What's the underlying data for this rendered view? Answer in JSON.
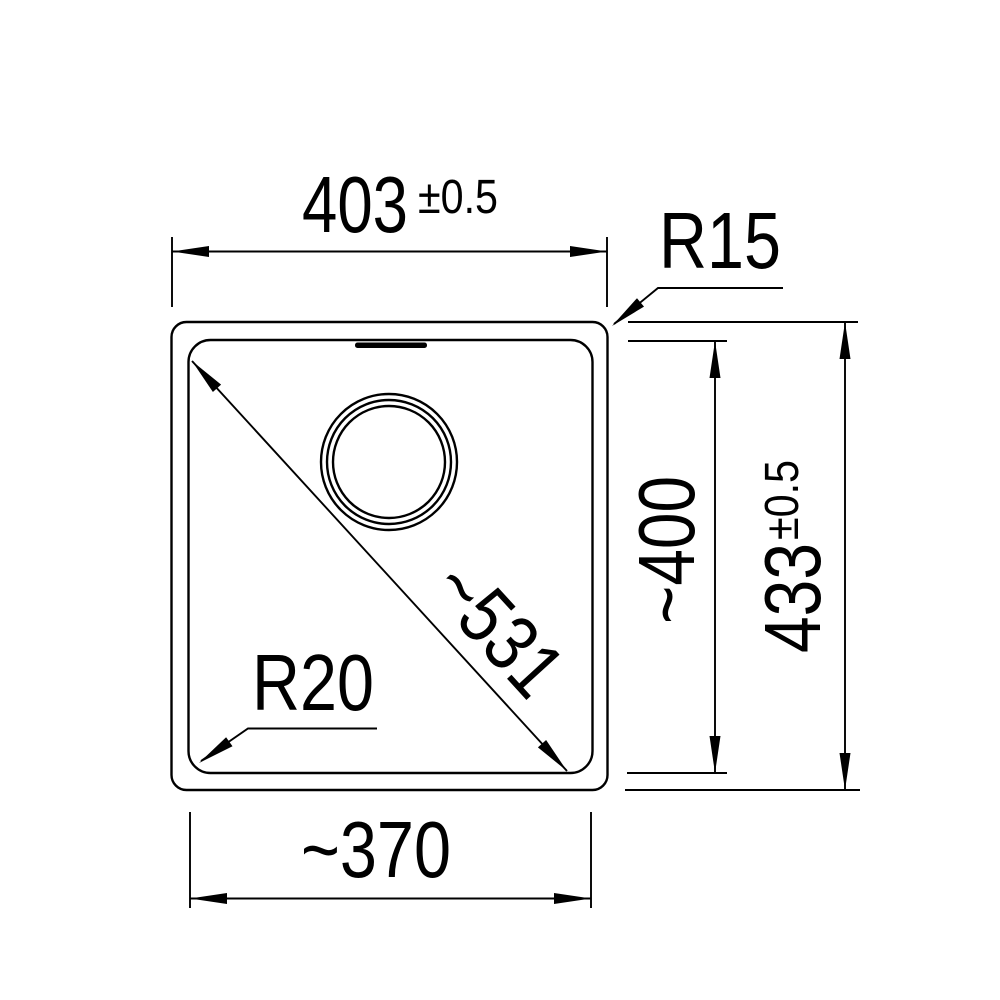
{
  "drawing_type": "technical dimension drawing",
  "colors": {
    "line": "#000000",
    "background": "#ffffff"
  },
  "labels": {
    "top_width": "403",
    "top_width_tolerance": "±0.5",
    "corner_radius_outer": "R15",
    "diagonal_length": "~531",
    "corner_radius_inner": "R20",
    "inner_depth": "~400",
    "outer_depth": "433",
    "outer_depth_tolerance": "±0.5",
    "bottom_width": "~370"
  },
  "dimensions": [
    {
      "label": "403",
      "tolerance": "±0.5",
      "kind": "linear",
      "orientation": "horizontal-top"
    },
    {
      "label": "R15",
      "kind": "radius-callout-outer-corner"
    },
    {
      "label": "~531",
      "kind": "linear",
      "orientation": "diagonal"
    },
    {
      "label": "R20",
      "kind": "radius-callout-inner-corner"
    },
    {
      "label": "~400",
      "kind": "linear",
      "orientation": "vertical-inner"
    },
    {
      "label": "433",
      "tolerance": "±0.5",
      "kind": "linear",
      "orientation": "vertical-outer"
    },
    {
      "label": "~370",
      "kind": "linear",
      "orientation": "horizontal-bottom"
    }
  ]
}
